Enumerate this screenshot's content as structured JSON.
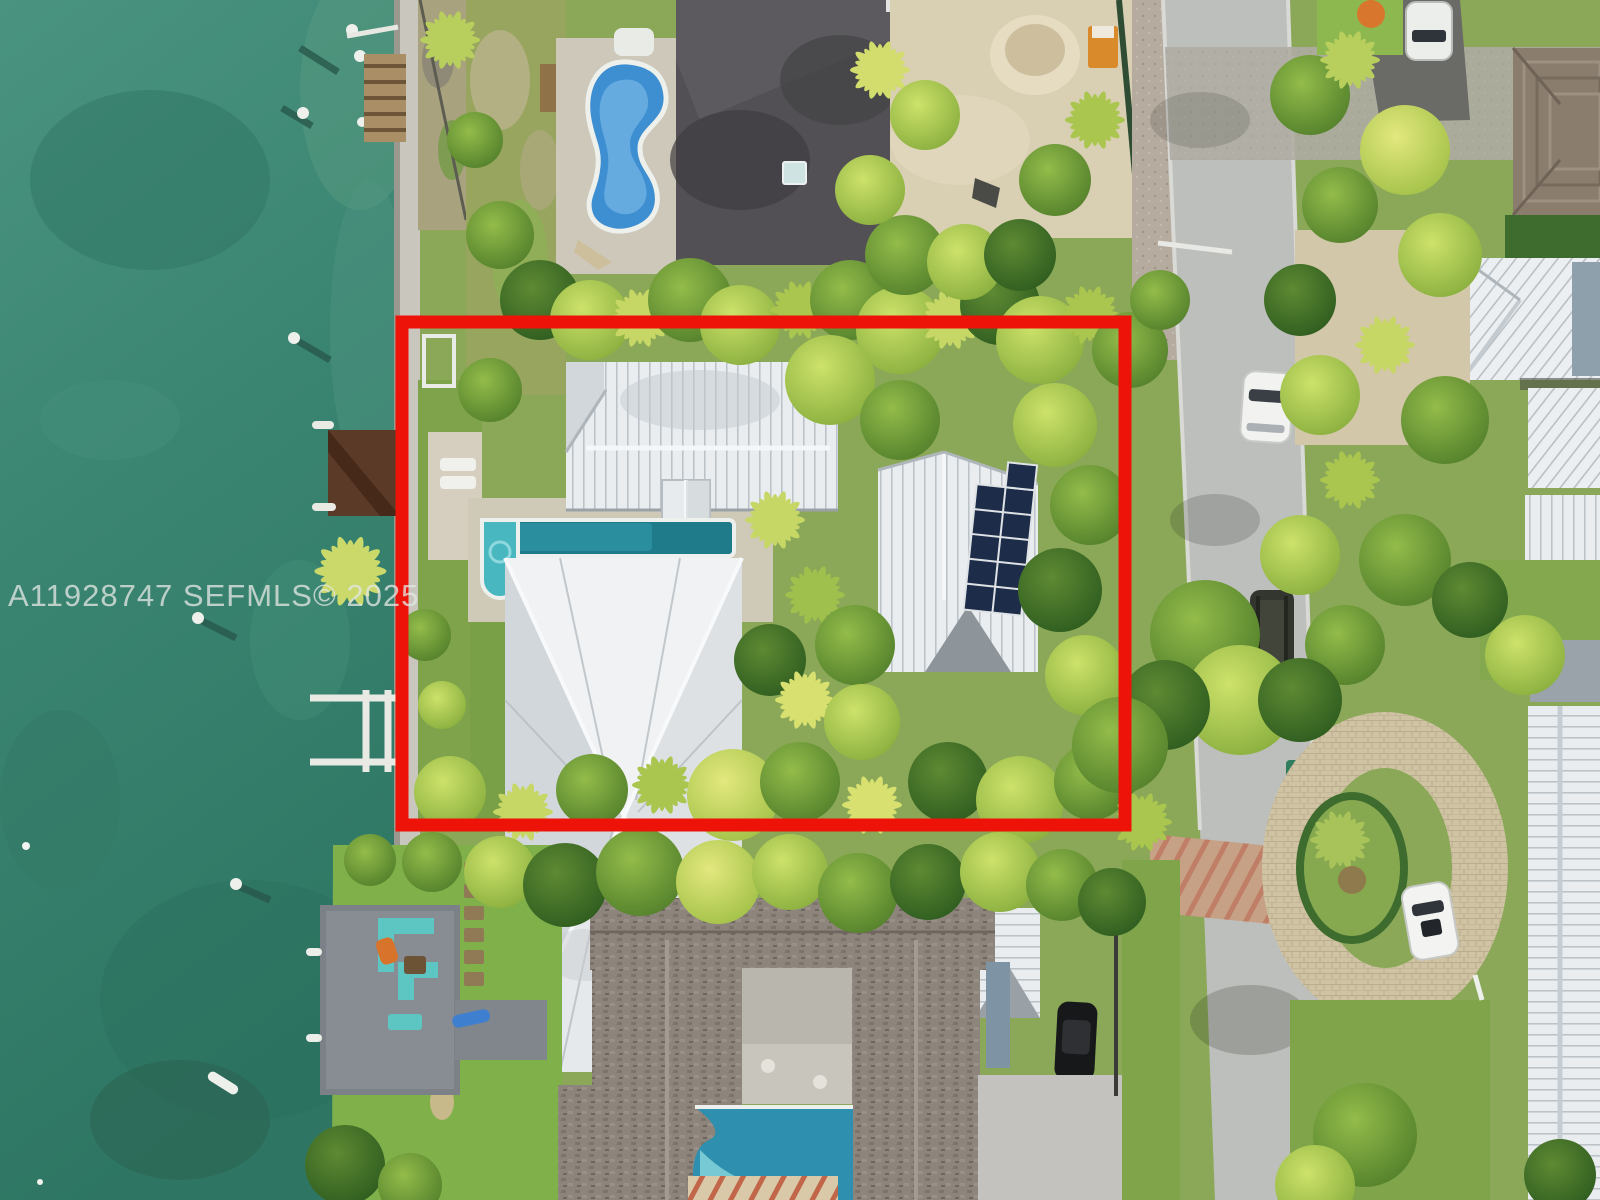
{
  "watermark": {
    "text": "A11928747  SEFMLS© 2025",
    "mls_number": "A11928747",
    "source": "SEFMLS©",
    "year": "2025"
  },
  "annotation": {
    "type": "property-boundary-highlight",
    "color": "#ee1309"
  },
  "palette": {
    "water": "#3a8572",
    "water_deep": "#2e7663",
    "grass": "#7fa34b",
    "canopy_bright": "#b8cf56",
    "canopy_dark": "#3f7026",
    "metal_roof": "#e9edef",
    "shingle_roof": "#8d857b",
    "dark_flat_roof": "#525055",
    "road": "#b7bab6",
    "sand": "#d9cfb2",
    "pool_blue": "#3e8ed2",
    "lap_pool_teal": "#2a8e9e",
    "solar_panel": "#1d2d49",
    "highlight_red": "#ee1309"
  }
}
